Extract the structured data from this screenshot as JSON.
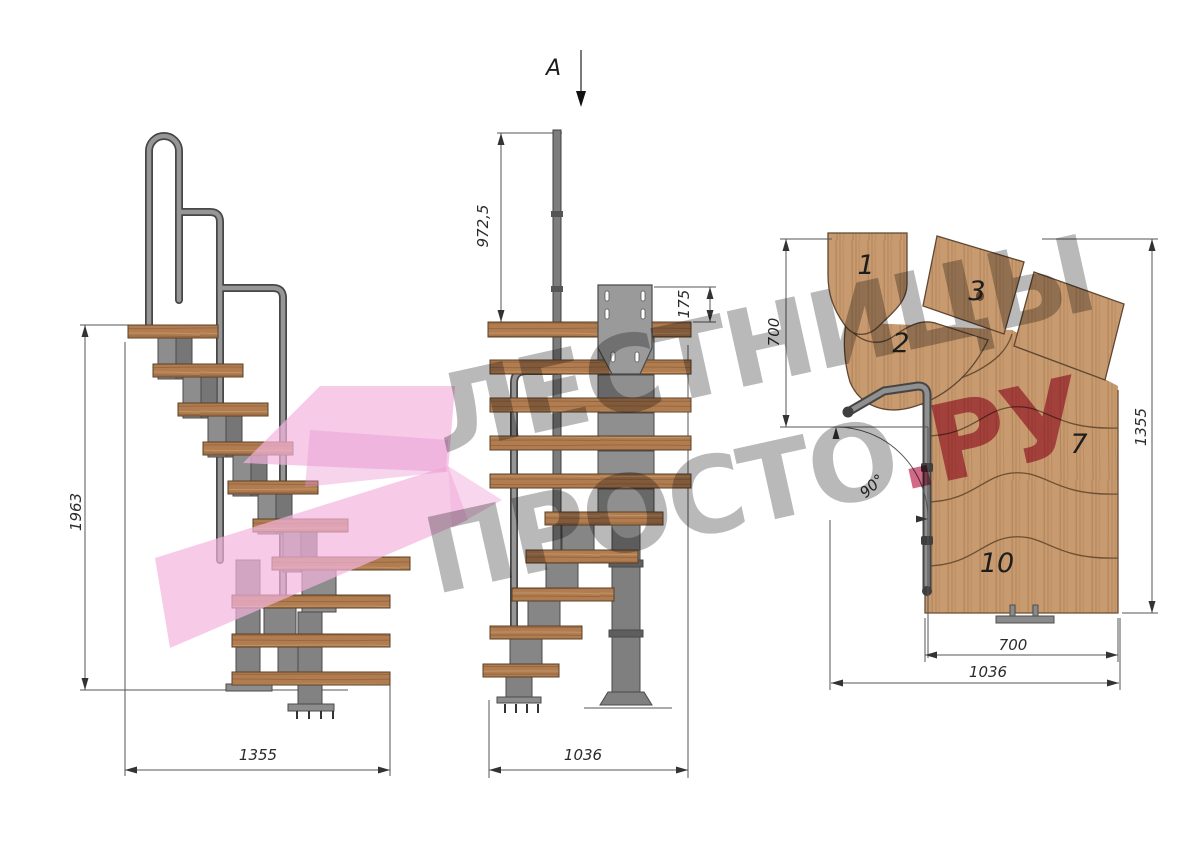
{
  "section_marker": {
    "label": "A"
  },
  "side_view": {
    "height": "1963",
    "width": "1355"
  },
  "front_view": {
    "rail_height": "972,5",
    "bracket_offset": "175",
    "width": "1036"
  },
  "plan_view": {
    "entry_depth": "700",
    "total_depth": "1355",
    "tread_width": "700",
    "total_width": "1036",
    "turn_angle": "90°",
    "tread_numbers": [
      "1",
      "2",
      "3",
      "7",
      "10"
    ]
  },
  "watermark": {
    "line1": "ЛЕСТНИЦЫ",
    "line2": "ПРОСТО",
    "accent": ".РУ"
  },
  "colors": {
    "wood_plan": "#c79a6f",
    "wood_tread": "#b07c50",
    "metal": "#8d8d8d",
    "line": "#555555",
    "watermark_gray": "#b9b9b9",
    "watermark_pink": "#d06a86",
    "ribbon_pink": "#f3b5de"
  }
}
